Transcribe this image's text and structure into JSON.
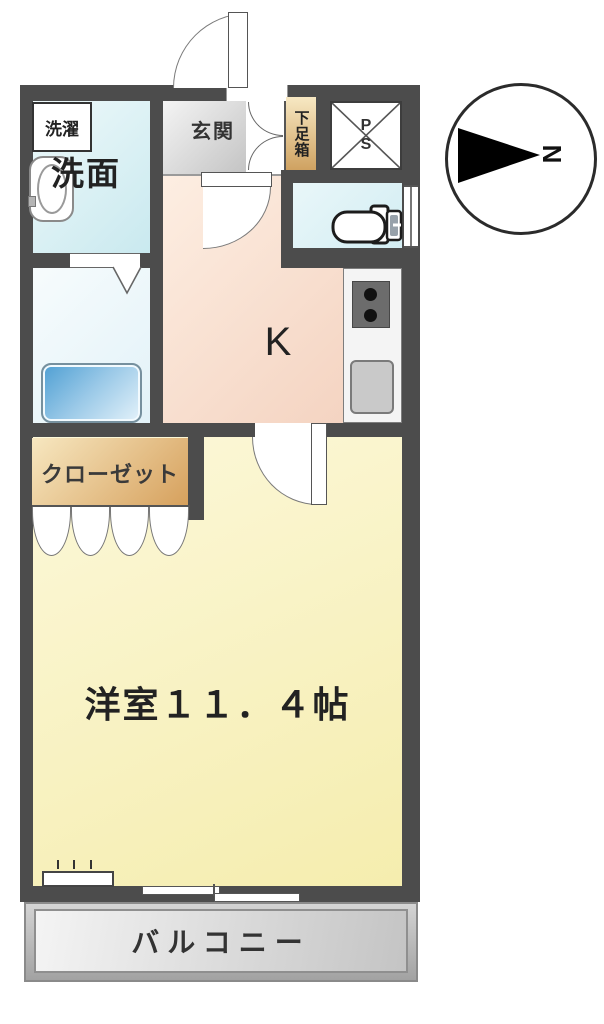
{
  "labels": {
    "laundry": "洗濯",
    "washroom": "洗面",
    "entrance": "玄関",
    "shoe_cabinet": "下足箱",
    "pipe_space_p": "P",
    "pipe_space_s": "S",
    "kitchen": "K",
    "closet": "クローゼット",
    "western_room": "洋室１１．４帖",
    "balcony": "バルコニー",
    "compass_north": "N"
  },
  "colors": {
    "wall": "#4c4c4c",
    "western_room_fill": "#f8f1c4",
    "kitchen_fill": "#f7dcca",
    "water_room_fill": "#d9eef3",
    "closet_fill": "#e3b470",
    "shoe_cabinet_fill": "#dfb475",
    "entrance_fill": "#d9d9d9",
    "balcony_fill": "#c9c9c9",
    "bathtub_fill": "#6aaede",
    "stove_fill": "#6c6c6c"
  }
}
